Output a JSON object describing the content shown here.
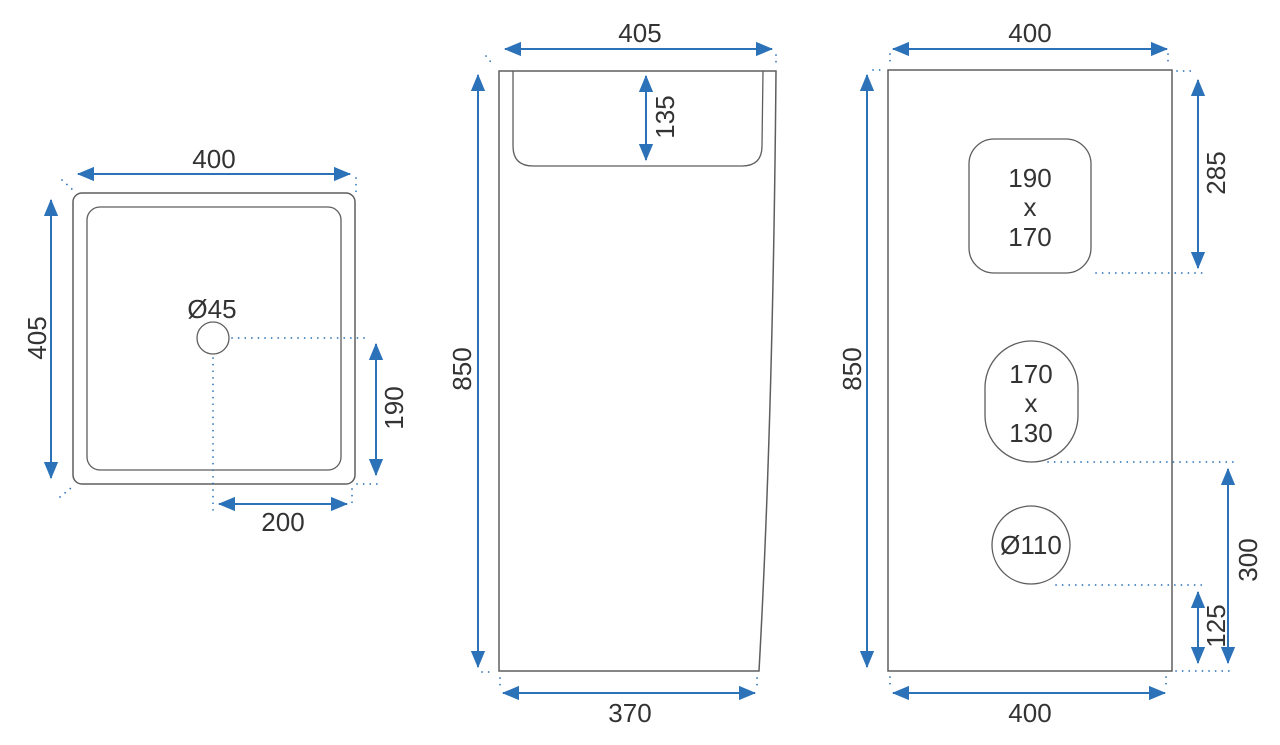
{
  "drawing_title": "washbasin-dimension-drawing",
  "colors": {
    "background": "#ffffff",
    "dimension_blue": "#2b72b8",
    "outline_gray": "#5e5e5e",
    "text_dark": "#333333"
  },
  "top_view": {
    "width": "400",
    "depth": "405",
    "drain_diameter": "Ø45",
    "drain_offset_back": "190",
    "drain_offset_side": "200"
  },
  "side_view": {
    "top_depth": "405",
    "basin_depth": "135",
    "height": "850",
    "bottom_depth": "370"
  },
  "front_view": {
    "top_width": "400",
    "height": "850",
    "rect_cutout_offset": "285",
    "rect_cutout": [
      "190",
      "x",
      "170"
    ],
    "oval_cutout": [
      "170",
      "x",
      "130"
    ],
    "oval_cutout_offset": "300",
    "tap_hole": "Ø110",
    "tap_hole_offset": "125",
    "bottom_width": "400"
  }
}
